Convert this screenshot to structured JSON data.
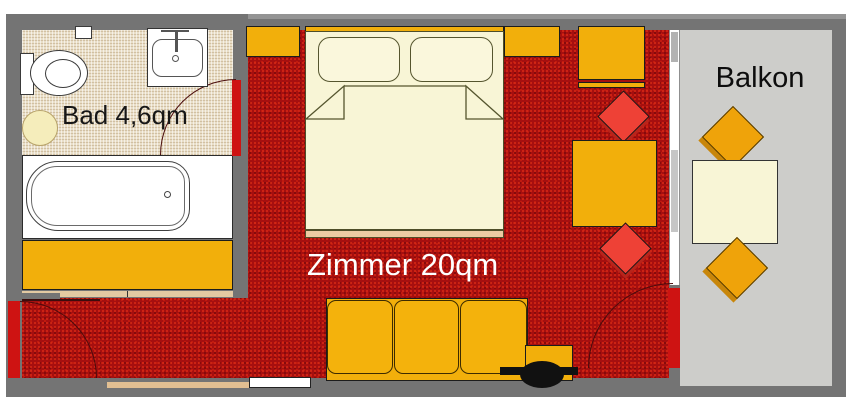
{
  "floorplan": {
    "rooms": [
      {
        "name": "bathroom",
        "label": "Bad 4,6qm",
        "area_qm": "4,6",
        "items": [
          "toilet",
          "washbasin",
          "faucet",
          "bathtub",
          "stool",
          "wall-cabinet",
          "wardrobe",
          "bathroom-door"
        ]
      },
      {
        "name": "room",
        "label": "Zimmer 20qm",
        "area_qm": "20",
        "items": [
          "double-bed",
          "pillow-left",
          "pillow-right",
          "headboard",
          "nightstand-left",
          "nightstand-right",
          "desk",
          "red-chair-upper",
          "side-table",
          "red-chair-lower",
          "sofa",
          "tv",
          "tv-stand",
          "entrance-door",
          "window-front",
          "radiator"
        ]
      },
      {
        "name": "balcony",
        "label": "Balkon",
        "items": [
          "balcony-chair-upper",
          "balcony-table",
          "balcony-chair-lower",
          "balcony-door"
        ]
      }
    ],
    "colors": {
      "wall_gray": "#747474",
      "carpet_red": "#a60f0f",
      "door_red": "#ce1312",
      "furniture_orange": "#f2af0b",
      "chair_red": "#ee4136",
      "bed_cream": "#f8f5d6",
      "bath_floor_tan": "#e9dec7",
      "balcony_floor_gray": "#cdcdca"
    }
  }
}
